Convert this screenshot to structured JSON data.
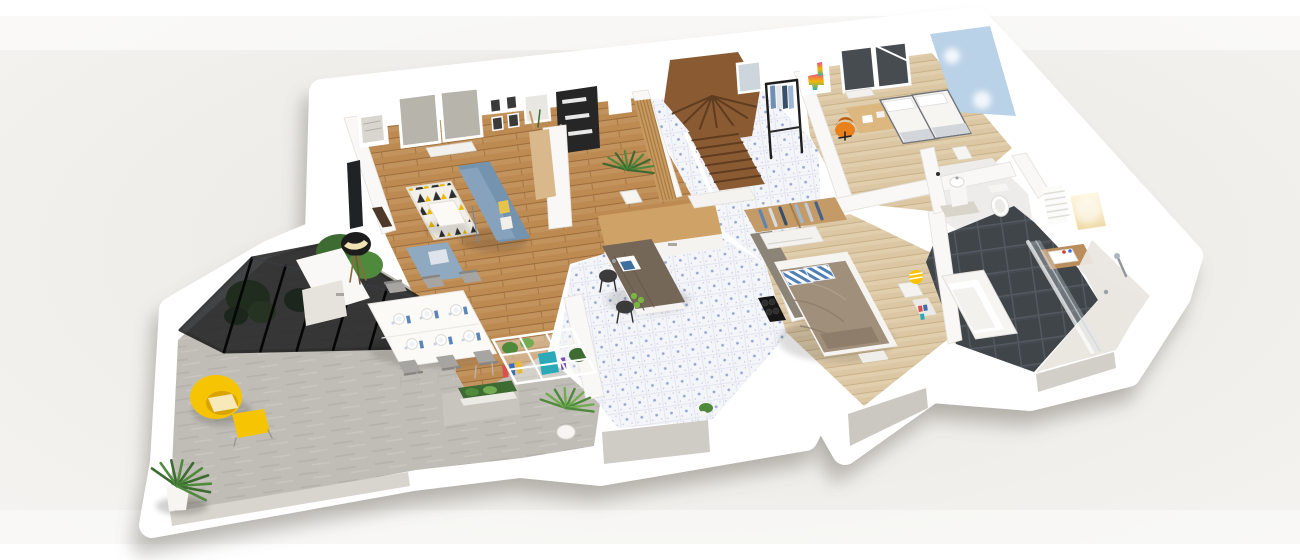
{
  "scene": {
    "type": "3d-floorplan-render",
    "view": "isometric-cutaway",
    "width_px": 1300,
    "height_px": 560
  },
  "palette": {
    "background_center": "#e9e7e2",
    "background_edge": "#f4f3f0",
    "sticker_white": "#ffffff",
    "cast_shadow": "rgba(115,110,100,0.33)",
    "wall": "#f9f8f6",
    "wall_edge": "#e4e1db",
    "wall_face_gray": "#cfccc5",
    "wood_floor": "#bd8a52",
    "wood_plank_light": "#c89a67",
    "wood_plank_line": "#9c6c3a",
    "pale_wood_floor": "#dbc7a4",
    "pale_wood_line": "#c9b28a",
    "tile_floor": "#f4f5f9",
    "tile_dot": "#8598c7",
    "tile_line": "#e2e6f0",
    "dark_tile": "#40454a",
    "dark_tile_line": "#545a61",
    "concrete": "#c0bdb6",
    "concrete_streak": "#b2afa8",
    "pergola_glass": "#141517",
    "sofa": "#86a2bc",
    "sofa_dark": "#7493ae",
    "ottoman": "#8fa9c1",
    "rug_base": "#f3f0e9",
    "rug_black": "#2e2e2e",
    "rug_yellow": "#e9b801",
    "accent_yellow": "#f6c402",
    "accent_yellow_dark": "#d9a400",
    "stair_wood": "#8a5a33",
    "stair_wood_dark": "#5f3c1f",
    "door_dark": "#262626",
    "table_white": "#fbfaf7",
    "chair_gray": "#a6a5a1",
    "chair_gray_dark": "#8f8e8a",
    "counter_gray": "#8d8478",
    "island_top": "#756758",
    "counter_wood": "#cfa368",
    "cooktop_black": "#161616",
    "sink_blue": "#3f6f9e",
    "bed_duvet": "#a08f7b",
    "bed_fold": "#8c7c69",
    "pillow_stripe_blue": "#4f7fb5",
    "kids_bed_white": "#f6f5f2",
    "kids_blanket": "#d2d6da",
    "bed_trim": "#70747a",
    "blue_accent_wall": "#bad2e8",
    "desk_wood": "#dcb77f",
    "office_chair_orange": "#e8811c",
    "wardrobe_wood": "#c49a66",
    "green_dark": "#3d6b31",
    "green_mid": "#4f8a3c",
    "green_light": "#72ab52",
    "pot_white": "#f6f5f2",
    "window_glass_gray": "#b7b4ac",
    "window_glass_dark": "#474c51",
    "bath_white": "#f4f3f0",
    "vanity_wood": "#bb8d5c",
    "marble_light": "#eae6e0",
    "teal_box": "#2aa9b8",
    "napkin_blue": "#5b84b8",
    "tap_red": "#d23b2f",
    "tap_blue": "#3b6fd2",
    "art_pink": "#e84a8f",
    "art_yellow": "#f2b705",
    "art_teal": "#2fb3a6"
  },
  "rooms": [
    {
      "name": "terrace",
      "floor": "concrete"
    },
    {
      "name": "living-dining-room",
      "floor": "wood"
    },
    {
      "name": "entrance-hall",
      "floor": "patterned-tile"
    },
    {
      "name": "kitchen",
      "floor": "patterned-tile"
    },
    {
      "name": "kids-bedroom-office",
      "floor": "pale-wood"
    },
    {
      "name": "wc",
      "floor": "white"
    },
    {
      "name": "master-bedroom",
      "floor": "pale-wood"
    },
    {
      "name": "bathroom",
      "floor": "dark-tile"
    }
  ],
  "furniture": {
    "terrace": [
      "glass-pergola",
      "potted-palm",
      "garden-tree",
      "yellow-armchair",
      "yellow-ottoman",
      "potted-plant"
    ],
    "living": [
      "wall-tv",
      "tv-unit",
      "floor-lamp",
      "triangle-rug",
      "coffee-table",
      "blue-sofa",
      "blue-ottoman",
      "radiator",
      "window",
      "map-frame",
      "photo-frames",
      "entrance-door",
      "console-table",
      "storage-halfwall"
    ],
    "dining": [
      "dining-table",
      "six-chairs",
      "place-settings",
      "grid-shelf",
      "planter-hedge",
      "potted-palm"
    ],
    "hall": [
      "winder-staircase",
      "stair-window",
      "slat-screen",
      "clothes-rack",
      "potted-palm"
    ],
    "kitchen": [
      "island-with-sink",
      "bar-stools",
      "counter-with-cooktop",
      "wood-counter",
      "apples"
    ],
    "kids_bedroom": [
      "llama-artwork",
      "window",
      "desk",
      "orange-office-chair",
      "radiator",
      "twin-beds",
      "blue-accent-wall",
      "nightstand"
    ],
    "wc": [
      "pedestal-sink",
      "toilet",
      "floor-mat"
    ],
    "master_bedroom": [
      "open-wardrobe",
      "dresser",
      "double-bed",
      "striped-pillows",
      "nightstand",
      "yellow-stool",
      "bench"
    ],
    "bathroom": [
      "bathtub",
      "vanity-with-sink",
      "towel-radiator",
      "lit-niche",
      "glass-shower",
      "shower-column",
      "marble-wall"
    ]
  }
}
